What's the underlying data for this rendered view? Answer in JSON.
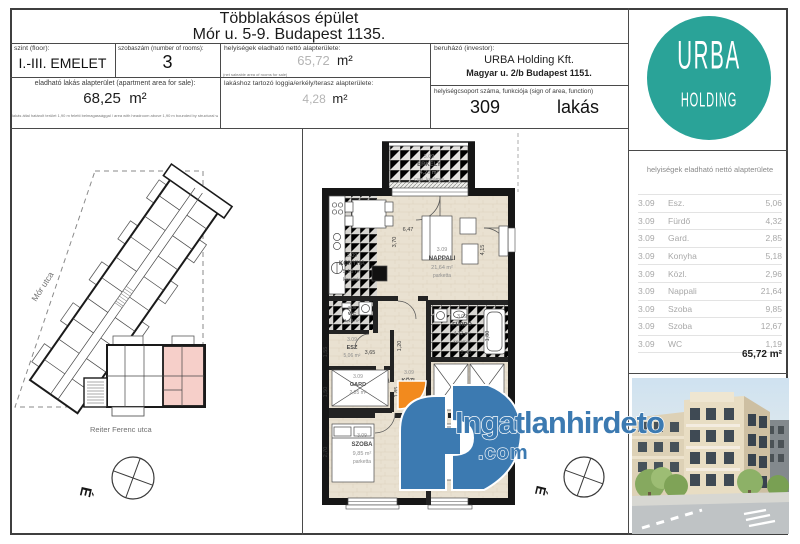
{
  "header": {
    "title_line1": "Többlakásos épület",
    "title_line2": "Mór u. 5-9. Budapest 1135.",
    "floor_label": "szint (floor):",
    "floor_value": "I.-III. EMELET",
    "rooms_label": "szobaszám (number of rooms):",
    "rooms_value": "3",
    "net_area_label": "helyiségek eladható nettó alapterülete:",
    "net_area_value": "65,72",
    "net_area_unit": "m²",
    "net_area_note": "(net saleable area of rooms for sale)",
    "investor_label": "beruházó (investor):",
    "investor_name": "URBA Holding Kft.",
    "investor_address": "Magyar u. 2/b Budapest 1151.",
    "unit_label": "helyiségcsoport száma, funkciója (sign of area, function)",
    "unit_number": "309",
    "unit_function": "lakás",
    "apt_area_label": "eladható lakás alapterület (apartment area for sale):",
    "apt_area_value": "68,25",
    "apt_area_unit": "m²",
    "apt_area_note": "lakás által határolt terület 1,90 m feletti belmagassággal / area with headroom above 1,90 m bounded by structural walls",
    "loggia_label": "lakáshoz tartozó loggia/erkély/terasz alapterülete:",
    "loggia_value": "4,28",
    "loggia_unit": "m²"
  },
  "logo": {
    "line1": "URBA",
    "line2": "HOLDING",
    "color": "#2aa398"
  },
  "sidebar_table": {
    "title": "helyiségek eladható nettó alapterülete",
    "rows": [
      {
        "code": "3.09",
        "name": "Esz.",
        "value": "5,06"
      },
      {
        "code": "3.09",
        "name": "Fürdő",
        "value": "4,32"
      },
      {
        "code": "3.09",
        "name": "Gard.",
        "value": "2,85"
      },
      {
        "code": "3.09",
        "name": "Konyha",
        "value": "5,18"
      },
      {
        "code": "3.09",
        "name": "Közl.",
        "value": "2,96"
      },
      {
        "code": "3.09",
        "name": "Nappali",
        "value": "21,64"
      },
      {
        "code": "3.09",
        "name": "Szoba",
        "value": "9,85"
      },
      {
        "code": "3.09",
        "name": "Szoba",
        "value": "12,67"
      },
      {
        "code": "3.09",
        "name": "WC",
        "value": "1,19"
      }
    ],
    "total": "65,72 m²"
  },
  "site_plan": {
    "street_left": "Mór utca",
    "street_bottom": "Reiter Ferenc utca",
    "highlight_color": "#f6cfc9"
  },
  "compass": {
    "north": "É"
  },
  "plan": {
    "rooms": {
      "erkely": [
        "3.09",
        "ERKÉLY",
        "4,28 m²",
        "csm. kerámia"
      ],
      "konyha": [
        "3.09",
        "KONYHA",
        "5,18 m²",
        "kerámia"
      ],
      "nappali": [
        "3.09",
        "NAPPALI",
        "21,64 m²",
        "parketta"
      ],
      "wc": [
        "3.09",
        "WC",
        "1,19 m²"
      ],
      "esz": [
        "3.09",
        "ESZ",
        "5,06 m²"
      ],
      "furdo": [
        "3.09",
        "FÜRDŐ",
        "4,32 m²",
        "kerámia"
      ],
      "gard": [
        "3.09",
        "GARD",
        "2,85 m²"
      ],
      "kozl": [
        "3.09",
        "KÖZL"
      ],
      "szoba1": [
        "3.09",
        "SZOBA",
        "9,85 m²",
        "parketta"
      ],
      "szoba2": [
        "3.09",
        "SZOBA",
        "12,67 m²",
        "parketta"
      ]
    },
    "dims": [
      "6,47",
      "3,70",
      "4,15",
      "3,65",
      "1,20",
      "2,40",
      "1,80",
      "1,60",
      "1,85",
      "2,70",
      "1,50",
      "1,55"
    ]
  },
  "watermark": {
    "text": "Ingatlanhirdeto",
    "suffix": ".com",
    "blue": "#3c7ab1",
    "orange": "#f28a1e"
  }
}
